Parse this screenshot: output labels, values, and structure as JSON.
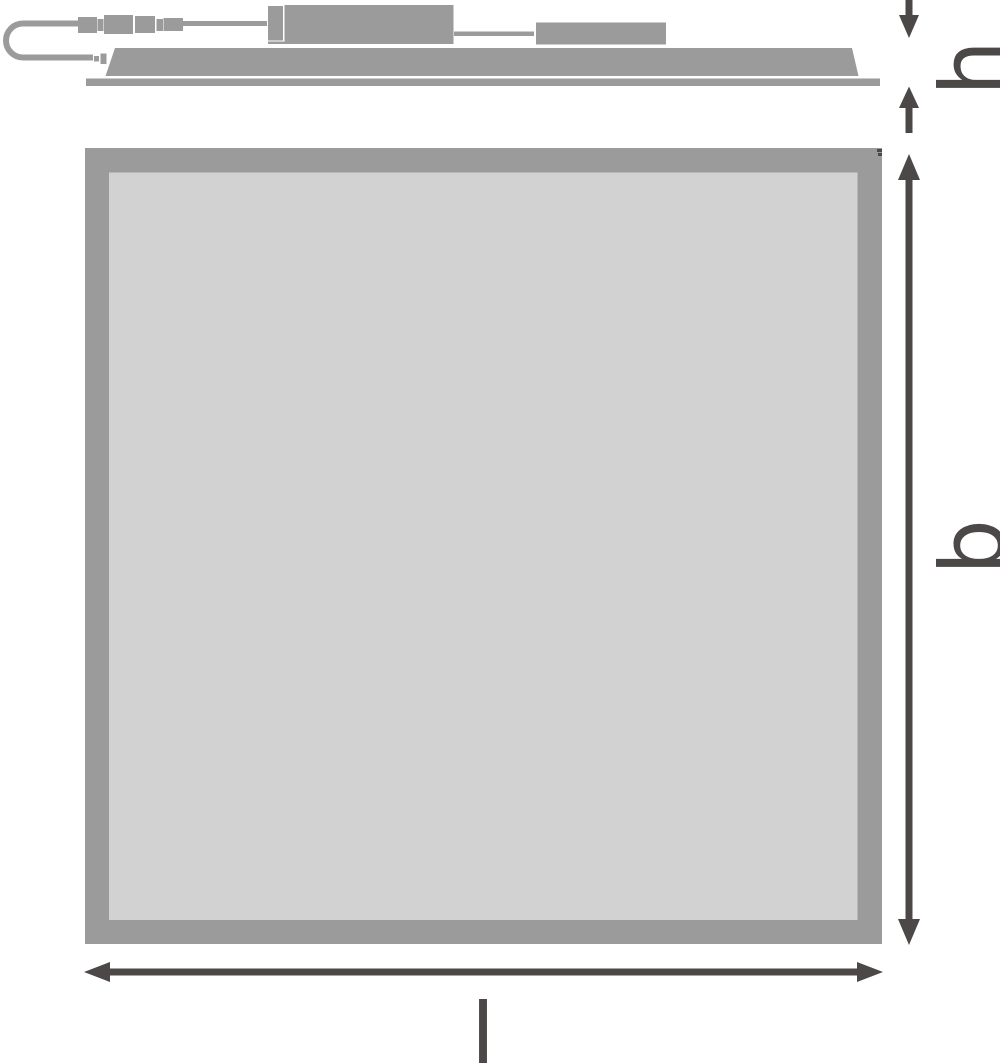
{
  "colors": {
    "device_gray": "#9c9b9b",
    "surface_gray": "#d3d2d2",
    "dimension_dark": "#4b4847",
    "background": "#ffffff"
  },
  "dimension_labels": {
    "h": "h",
    "b": "b",
    "l": "l"
  }
}
